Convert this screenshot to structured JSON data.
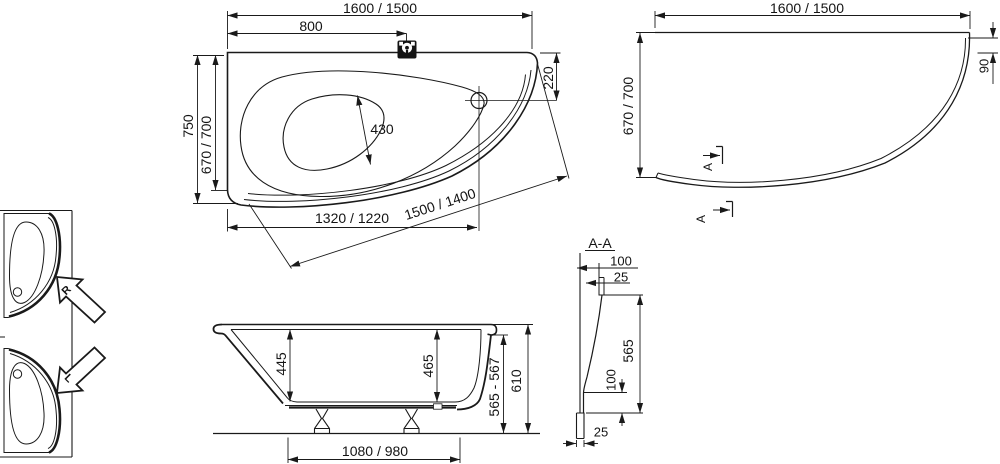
{
  "plan_view": {
    "overall_width": "1600 / 1500",
    "faucet_offset": "800",
    "depth_overall": "750",
    "depth_inner": "670 / 700",
    "basin_width": "430",
    "corner_edge": "220",
    "bottom_edge": "1320 / 1220",
    "front_edge": "1500 / 1400"
  },
  "contour_view": {
    "overall_width": "1600 / 1500",
    "depth": "670 / 700",
    "corner_drop": "90",
    "section_a_top": "A",
    "section_a_bottom": "A"
  },
  "front_view": {
    "depth_left": "445",
    "depth_right": "465",
    "rim_height": "565 - 567",
    "total_height": "610",
    "base_width": "1080 / 980"
  },
  "section_view": {
    "title": "A-A",
    "top_width": "100",
    "top_lip": "25",
    "height": "565",
    "base_height": "100",
    "foot_width": "25"
  },
  "orientation": {
    "right_label": "R",
    "left_label": "L"
  },
  "colors": {
    "line": "#1a1a1a",
    "background": "#ffffff"
  }
}
